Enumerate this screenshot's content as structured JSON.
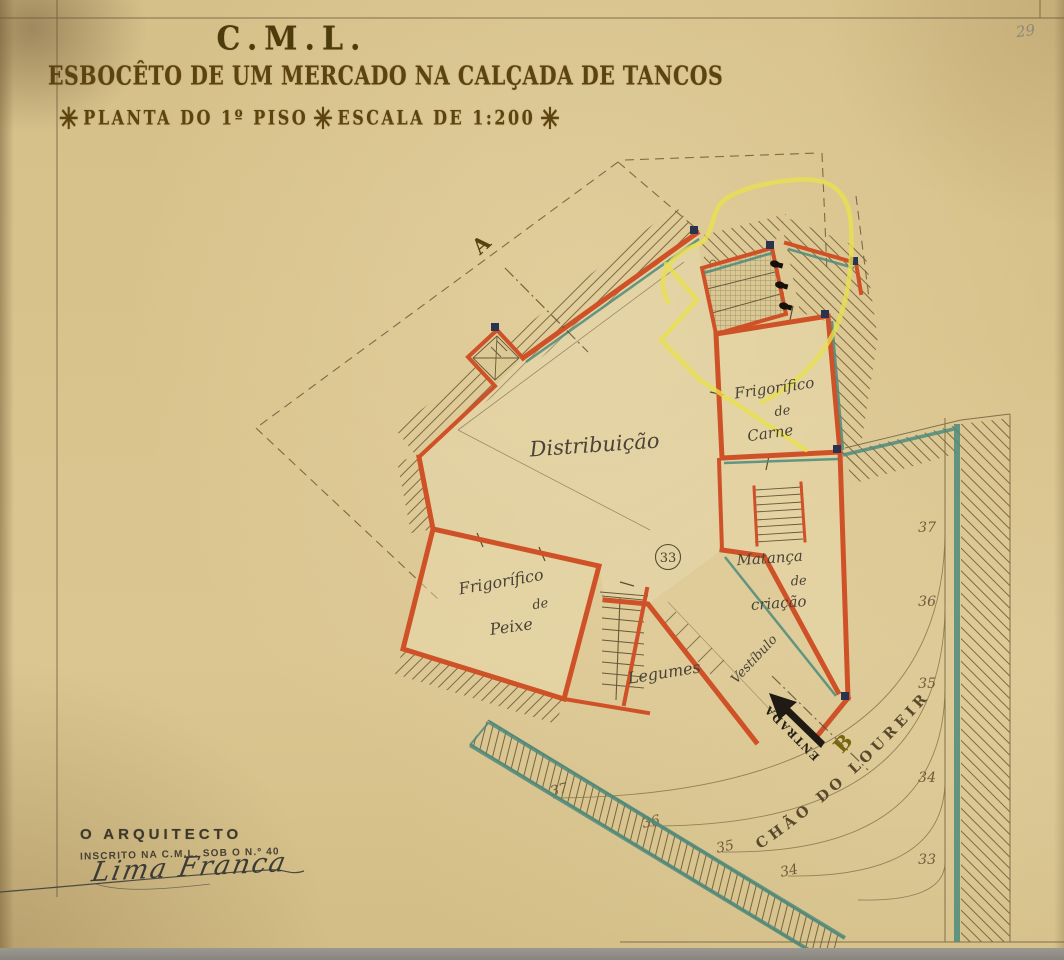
{
  "page": {
    "corner_number": "29"
  },
  "title_block": {
    "org": "C.M.L.",
    "title": "ESBOCÊTO DE UM MERCADO NA CALÇADA DE TANCOS",
    "star": "✳",
    "plan_label": "PLANTA DO 1º PISO",
    "scale_label": "ESCALA DE 1:200"
  },
  "plan": {
    "rooms": {
      "distribuicao": "Distribuição",
      "carne": [
        "Frigorífico",
        "de",
        "Carne"
      ],
      "peixe": [
        "Frigorífico",
        "de",
        "Peixe"
      ],
      "matanca": [
        "Matança",
        "de",
        "criação"
      ],
      "legumes": "Legumes",
      "vestibulo": "Vestíbulo",
      "stall_number": "33"
    },
    "markers": {
      "a": "A",
      "b": "B",
      "entrada": "ENTRADA"
    },
    "street_name": "CHÃO DO LOUREIRO",
    "contours": {
      "right": [
        "37",
        "36",
        "35",
        "34",
        "33"
      ],
      "bottom": [
        "37",
        "36",
        "35",
        "34"
      ]
    }
  },
  "architect_block": {
    "role": "O ARQUITECTO",
    "registration": "INSCRITO NA C.M.L. SOB O N.º 40",
    "signature": "Lima Franca"
  },
  "colors": {
    "paper": "#d8c28c",
    "wall_orange": "#cf5128",
    "accent_teal": "#4e8b7d",
    "highlight_yellow": "#e8e04e",
    "ink_brown": "#5c430f",
    "pencil_gray": "#8d887a"
  }
}
